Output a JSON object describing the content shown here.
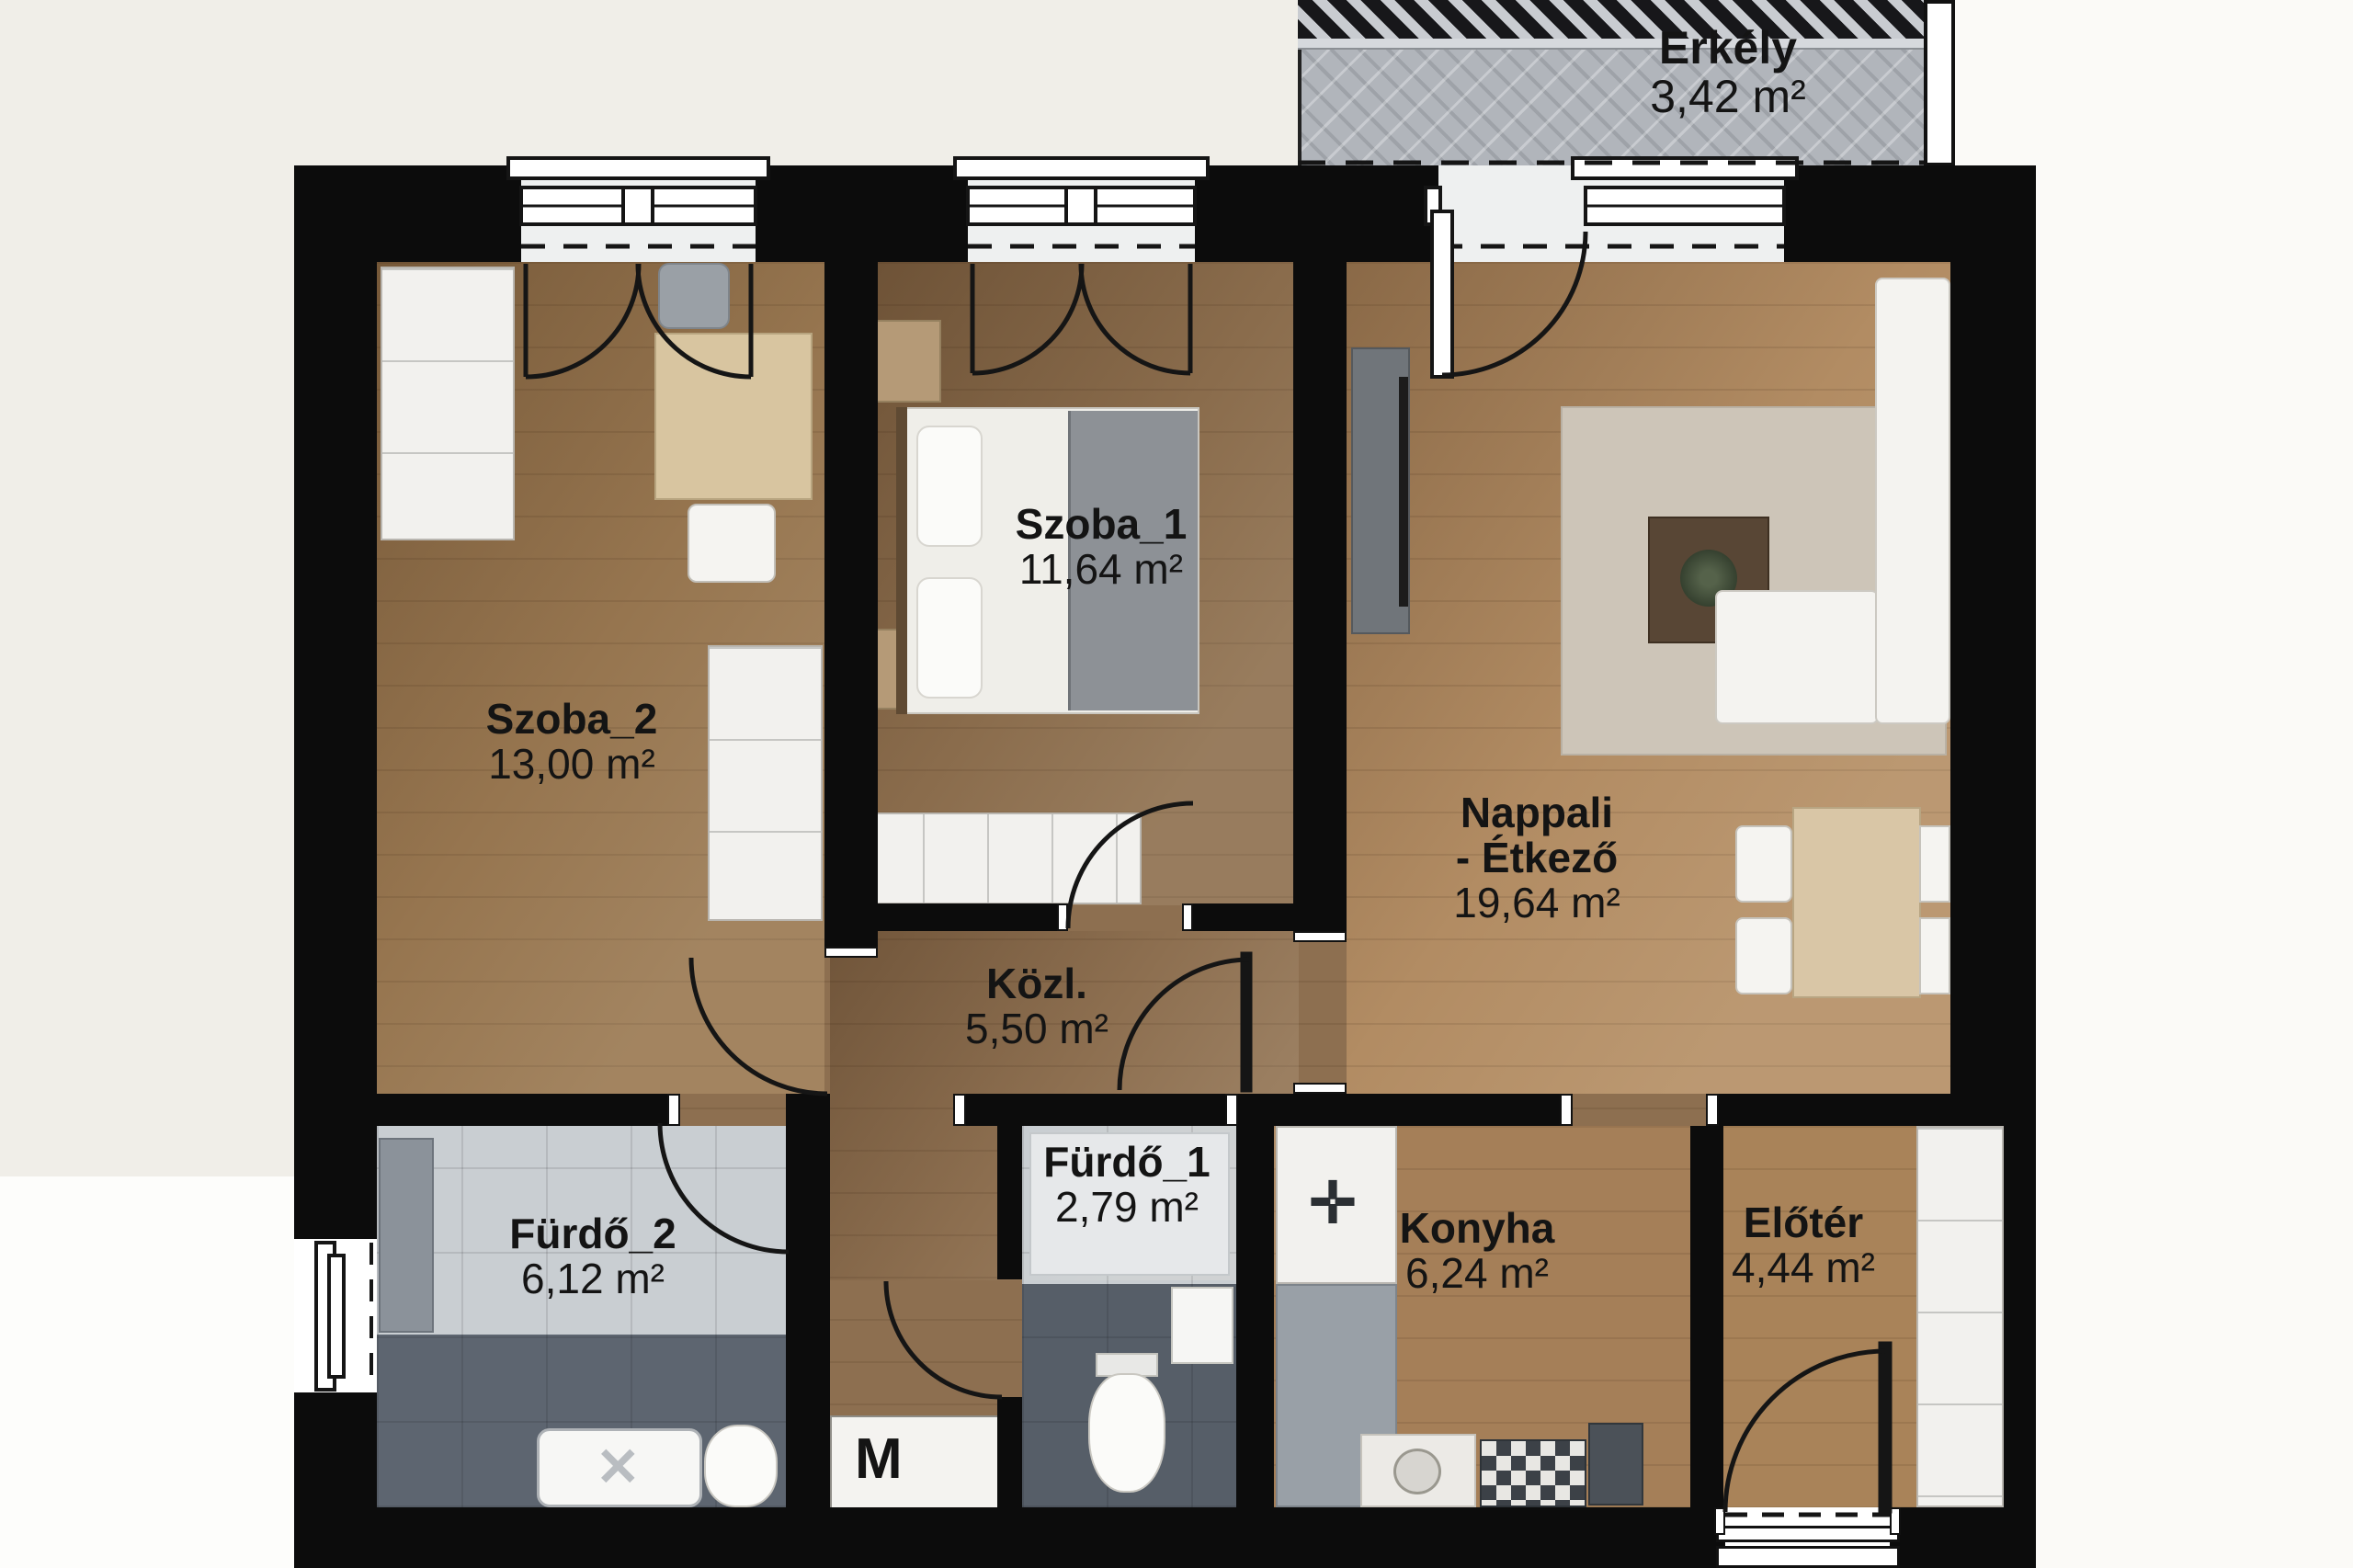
{
  "title": "Apartment floor plan",
  "rooms": [
    {
      "id": "erkely",
      "name": "Erkély",
      "area": "3,42 m²"
    },
    {
      "id": "szoba2",
      "name": "Szoba_2",
      "area": "13,00 m²"
    },
    {
      "id": "szoba1",
      "name": "Szoba_1",
      "area": "11,64 m²"
    },
    {
      "id": "nappali",
      "name": "Nappali",
      "name2": "- Étkező",
      "area": "19,64 m²"
    },
    {
      "id": "kozl",
      "name": "Közl.",
      "area": "5,50 m²"
    },
    {
      "id": "furdo1",
      "name": "Fürdő_1",
      "area": "2,79 m²"
    },
    {
      "id": "furdo2",
      "name": "Fürdő_2",
      "area": "6,12 m²"
    },
    {
      "id": "konyha",
      "name": "Konyha",
      "area": "6,24 m²"
    },
    {
      "id": "eloter",
      "name": "Előtér",
      "area": "4,44 m²"
    }
  ],
  "labels": {
    "washing_machine": "M"
  },
  "icons": {
    "stove": "✛",
    "shower_drain": "✕"
  },
  "palette": {
    "wall": "#0c0c0c",
    "background": "#f0eee8",
    "outside_white": "#fbfaf7",
    "wood_szoba2": "#96754f",
    "wood_szoba1": "#8a6c4c",
    "wood_nappali": "#b28c63",
    "wood_corridor": "#8d6f50",
    "wood_kitchen": "#a57f58",
    "tile_light": "#c9ced2",
    "tile_dark": "#565e68",
    "balcony_floor": "#b1b5bb",
    "furniture_white": "#f2f1ee"
  }
}
